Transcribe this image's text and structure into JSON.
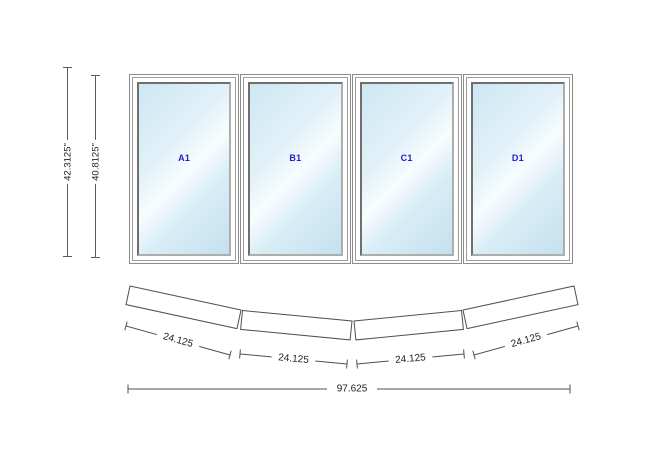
{
  "drawing": {
    "elevation": {
      "panels": [
        {
          "id": "A1"
        },
        {
          "id": "B1"
        },
        {
          "id": "C1"
        },
        {
          "id": "D1"
        }
      ],
      "overall_height_label": "42.3125\"",
      "frame_height_label": "40.8125\""
    },
    "plan": {
      "panel_width_labels": [
        "24.125",
        "24.125",
        "24.125",
        "24.125"
      ],
      "overall_width_label": "97.625"
    },
    "colors": {
      "panel_label_blue": "#2222cc",
      "dimension_text": "#222222",
      "outline_gray": "#4f4f4f"
    }
  }
}
